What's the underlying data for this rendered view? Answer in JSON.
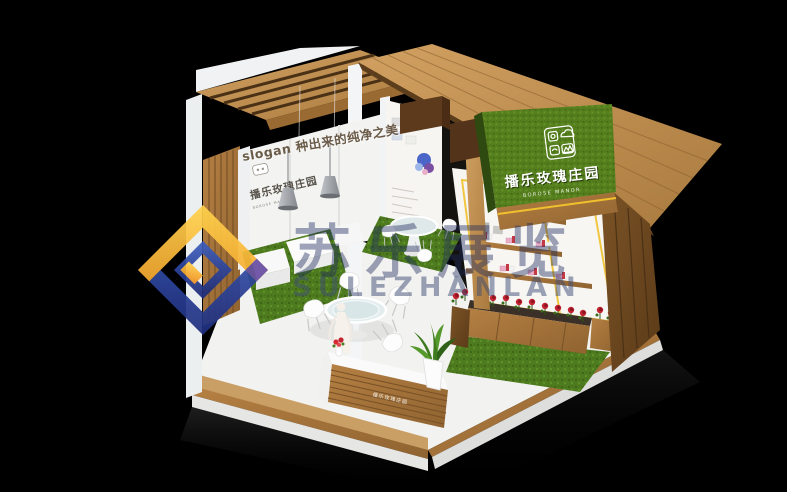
{
  "scene": {
    "background": "#000000"
  },
  "booth": {
    "slogan": "slogan 种出来的纯净之美",
    "back_wall_sign": {
      "title": "播乐玫瑰庄园",
      "subtitle": "BOROSE MANOR"
    },
    "main_sign": {
      "title": "播乐玫瑰庄园",
      "subtitle": "BOROSE MANOR",
      "logo_icons": [
        "rose-icon",
        "cloud-icon",
        "bird-icon",
        "mountains-icon"
      ],
      "panel_color": "#55801c"
    },
    "reception_desk_label": "播乐玫瑰庄园",
    "palette": {
      "wood": "#b07c3f",
      "wood_dark": "#6e4a22",
      "grass_green": "#4e7b1f",
      "accent_yellow": "#f0c12c",
      "rose_red": "#c22330",
      "floor_white": "#f2f2f0"
    }
  },
  "watermark": {
    "text_cn": "苏乐展览",
    "text_en": "SULEZHANLAN",
    "logo_gold": "#f0a31d",
    "logo_blue": "#2e4ca0",
    "logo_purple": "#6a4fa3"
  }
}
